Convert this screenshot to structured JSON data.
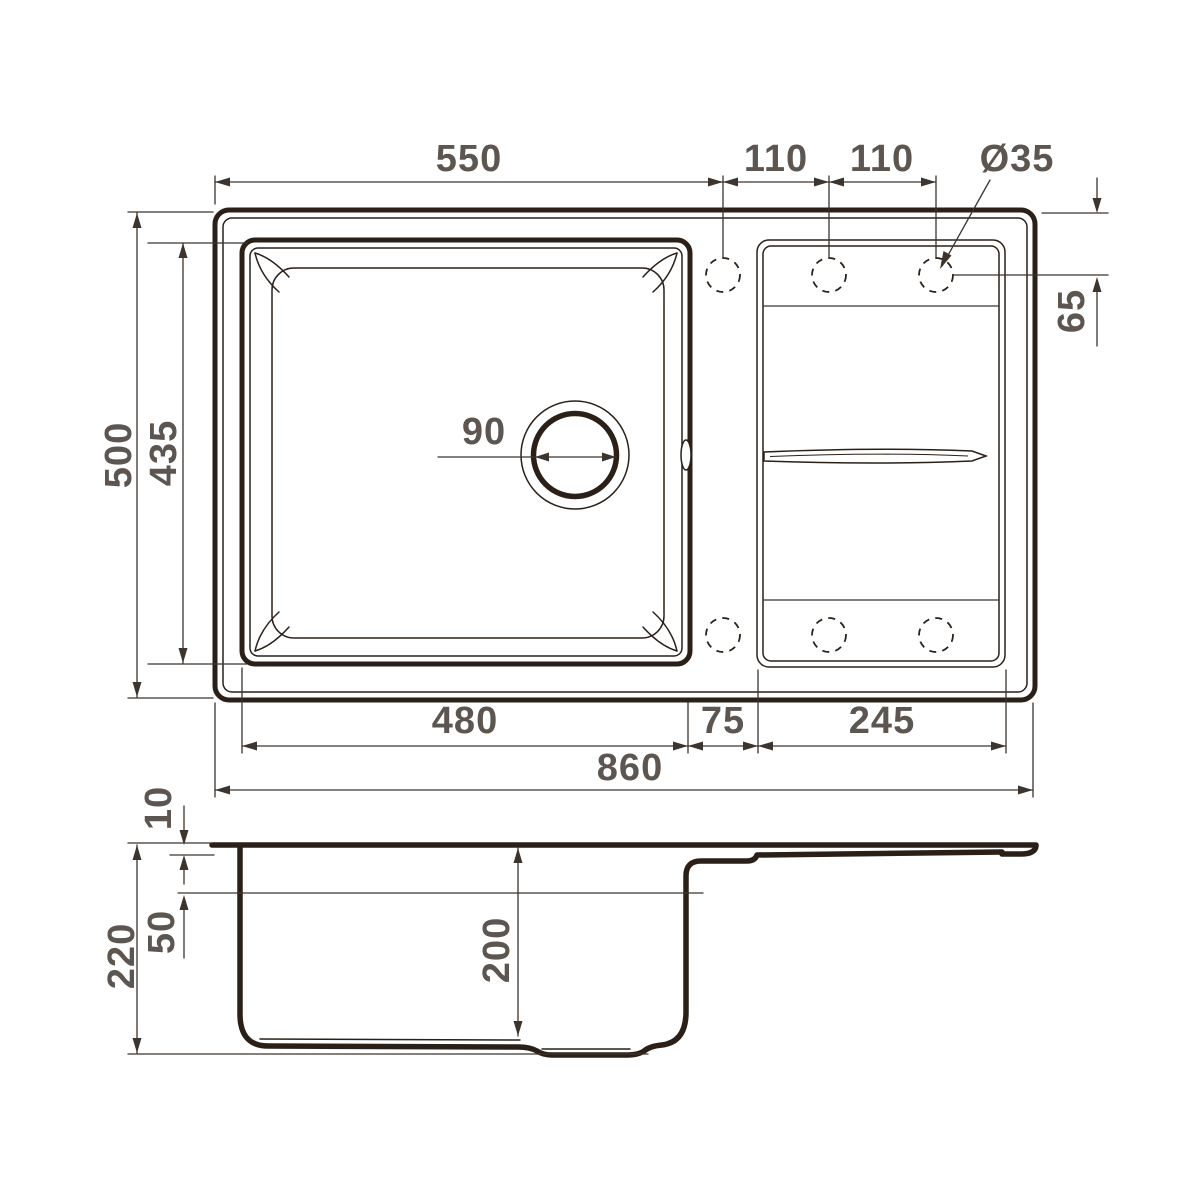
{
  "meta": {
    "drawing_type": "technical dimension drawing",
    "subject": "kitchen sink with single bowl and drainboard, top view and side section view"
  },
  "colors": {
    "background": "#ffffff",
    "outline": "#2a2018",
    "dimension_lines": "#3c342d",
    "labels": "#5d5650"
  },
  "labels": {
    "top": {
      "bowl_span": "550",
      "hole_pitch_left": "110",
      "hole_pitch_right": "110",
      "hole_diameter": "Ø35"
    },
    "right": {
      "hole_offset": "65"
    },
    "left": {
      "overall_depth": "500",
      "bowl_outer_depth": "435"
    },
    "drain": {
      "diameter": "90"
    },
    "bottom": {
      "bowl_inner_width": "480",
      "deck_width": "75",
      "drainboard_width": "245",
      "overall_width": "860"
    },
    "side": {
      "rim_height": "10",
      "upper_depth": "50",
      "overall_height": "220",
      "bowl_depth": "200"
    }
  }
}
